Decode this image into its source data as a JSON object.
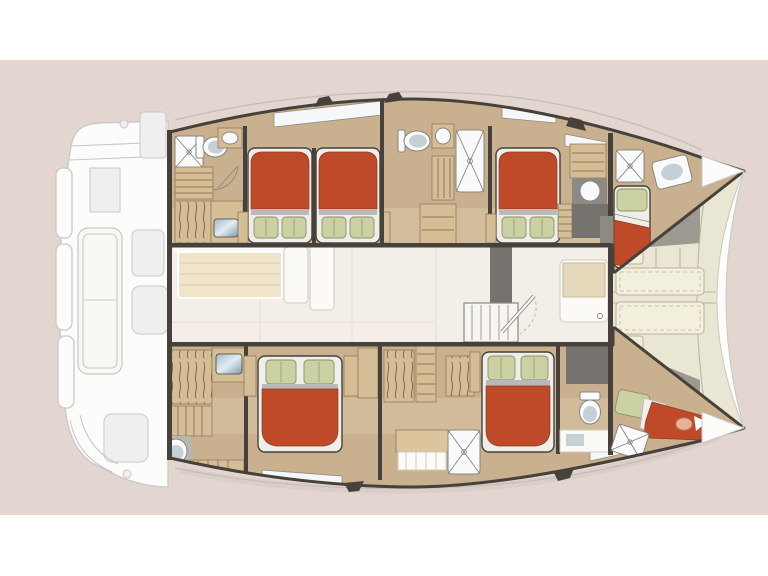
{
  "diagram": {
    "type": "catamaran-deck-floor-plan",
    "orientation": "bow-right",
    "areas": [
      "aft-deck-swim-platform",
      "port-hull",
      "starboard-hull",
      "saloon-galley",
      "forward-cockpit",
      "port-aft-bathroom",
      "port-aft-cabin",
      "port-mid-cabin",
      "port-mid-bathroom",
      "port-forward-cabin",
      "starboard-aft-bathroom",
      "starboard-aft-cabin",
      "starboard-mid-cabin",
      "starboard-forward-cabin"
    ],
    "icons": [
      "double-bed",
      "single-bed",
      "pillow",
      "toilet-icon",
      "shower-icon",
      "sink-icon",
      "round-sink-icon",
      "staircase-icon",
      "wardrobe-icon",
      "companionway-steps-icon",
      "bench-icon",
      "sun-pad-icon",
      "cleat-icon",
      "door-icon",
      "window-icon",
      "table-icon"
    ]
  },
  "palette": {
    "bg_page": "#ffffff",
    "bg_band": "#e3d5d0",
    "hull_floor": "#c9b08e",
    "hull_floor_light": "#d8c4a4",
    "outline": "#46413a",
    "bed_red": "#bf4a2a",
    "bed_red_dark": "#8e3a20",
    "pillow": "#ccd1a3",
    "pillow_line": "#8b9064",
    "linen": "#efeeea",
    "linen_shade": "#b9b9b7",
    "wood_mid": "#d5bd95",
    "wood_dark": "#8f7a5c",
    "salon_floor": "#f3eee7",
    "salon_seam": "#e6dfd4",
    "table_wood": "#f0e4cb",
    "table_line": "#dbcdae",
    "furniture": "#fbfaf6",
    "furniture_line": "#cfccc3",
    "foredeck": "#eae6d4",
    "bench": "#f2efdc",
    "bench_line": "#b8b39b",
    "grey_box": "#76726d",
    "grey_mid": "#9d9890",
    "porcelain": "#f8fafb",
    "porcelain_shade": "#c5cfd6",
    "fixture_line": "#8a857c",
    "window": "#f5f7f8",
    "deck_white": "#fcfcfb",
    "deck_line": "#c8c8c6",
    "deck_shade": "#eff0ee",
    "shadow": "#d5c6c1",
    "roofline": "#bdbab4",
    "glass1": "#9fb7c8",
    "glass2": "#e2edf3",
    "glass3": "#7f98ab",
    "skin": "#e8b098"
  }
}
